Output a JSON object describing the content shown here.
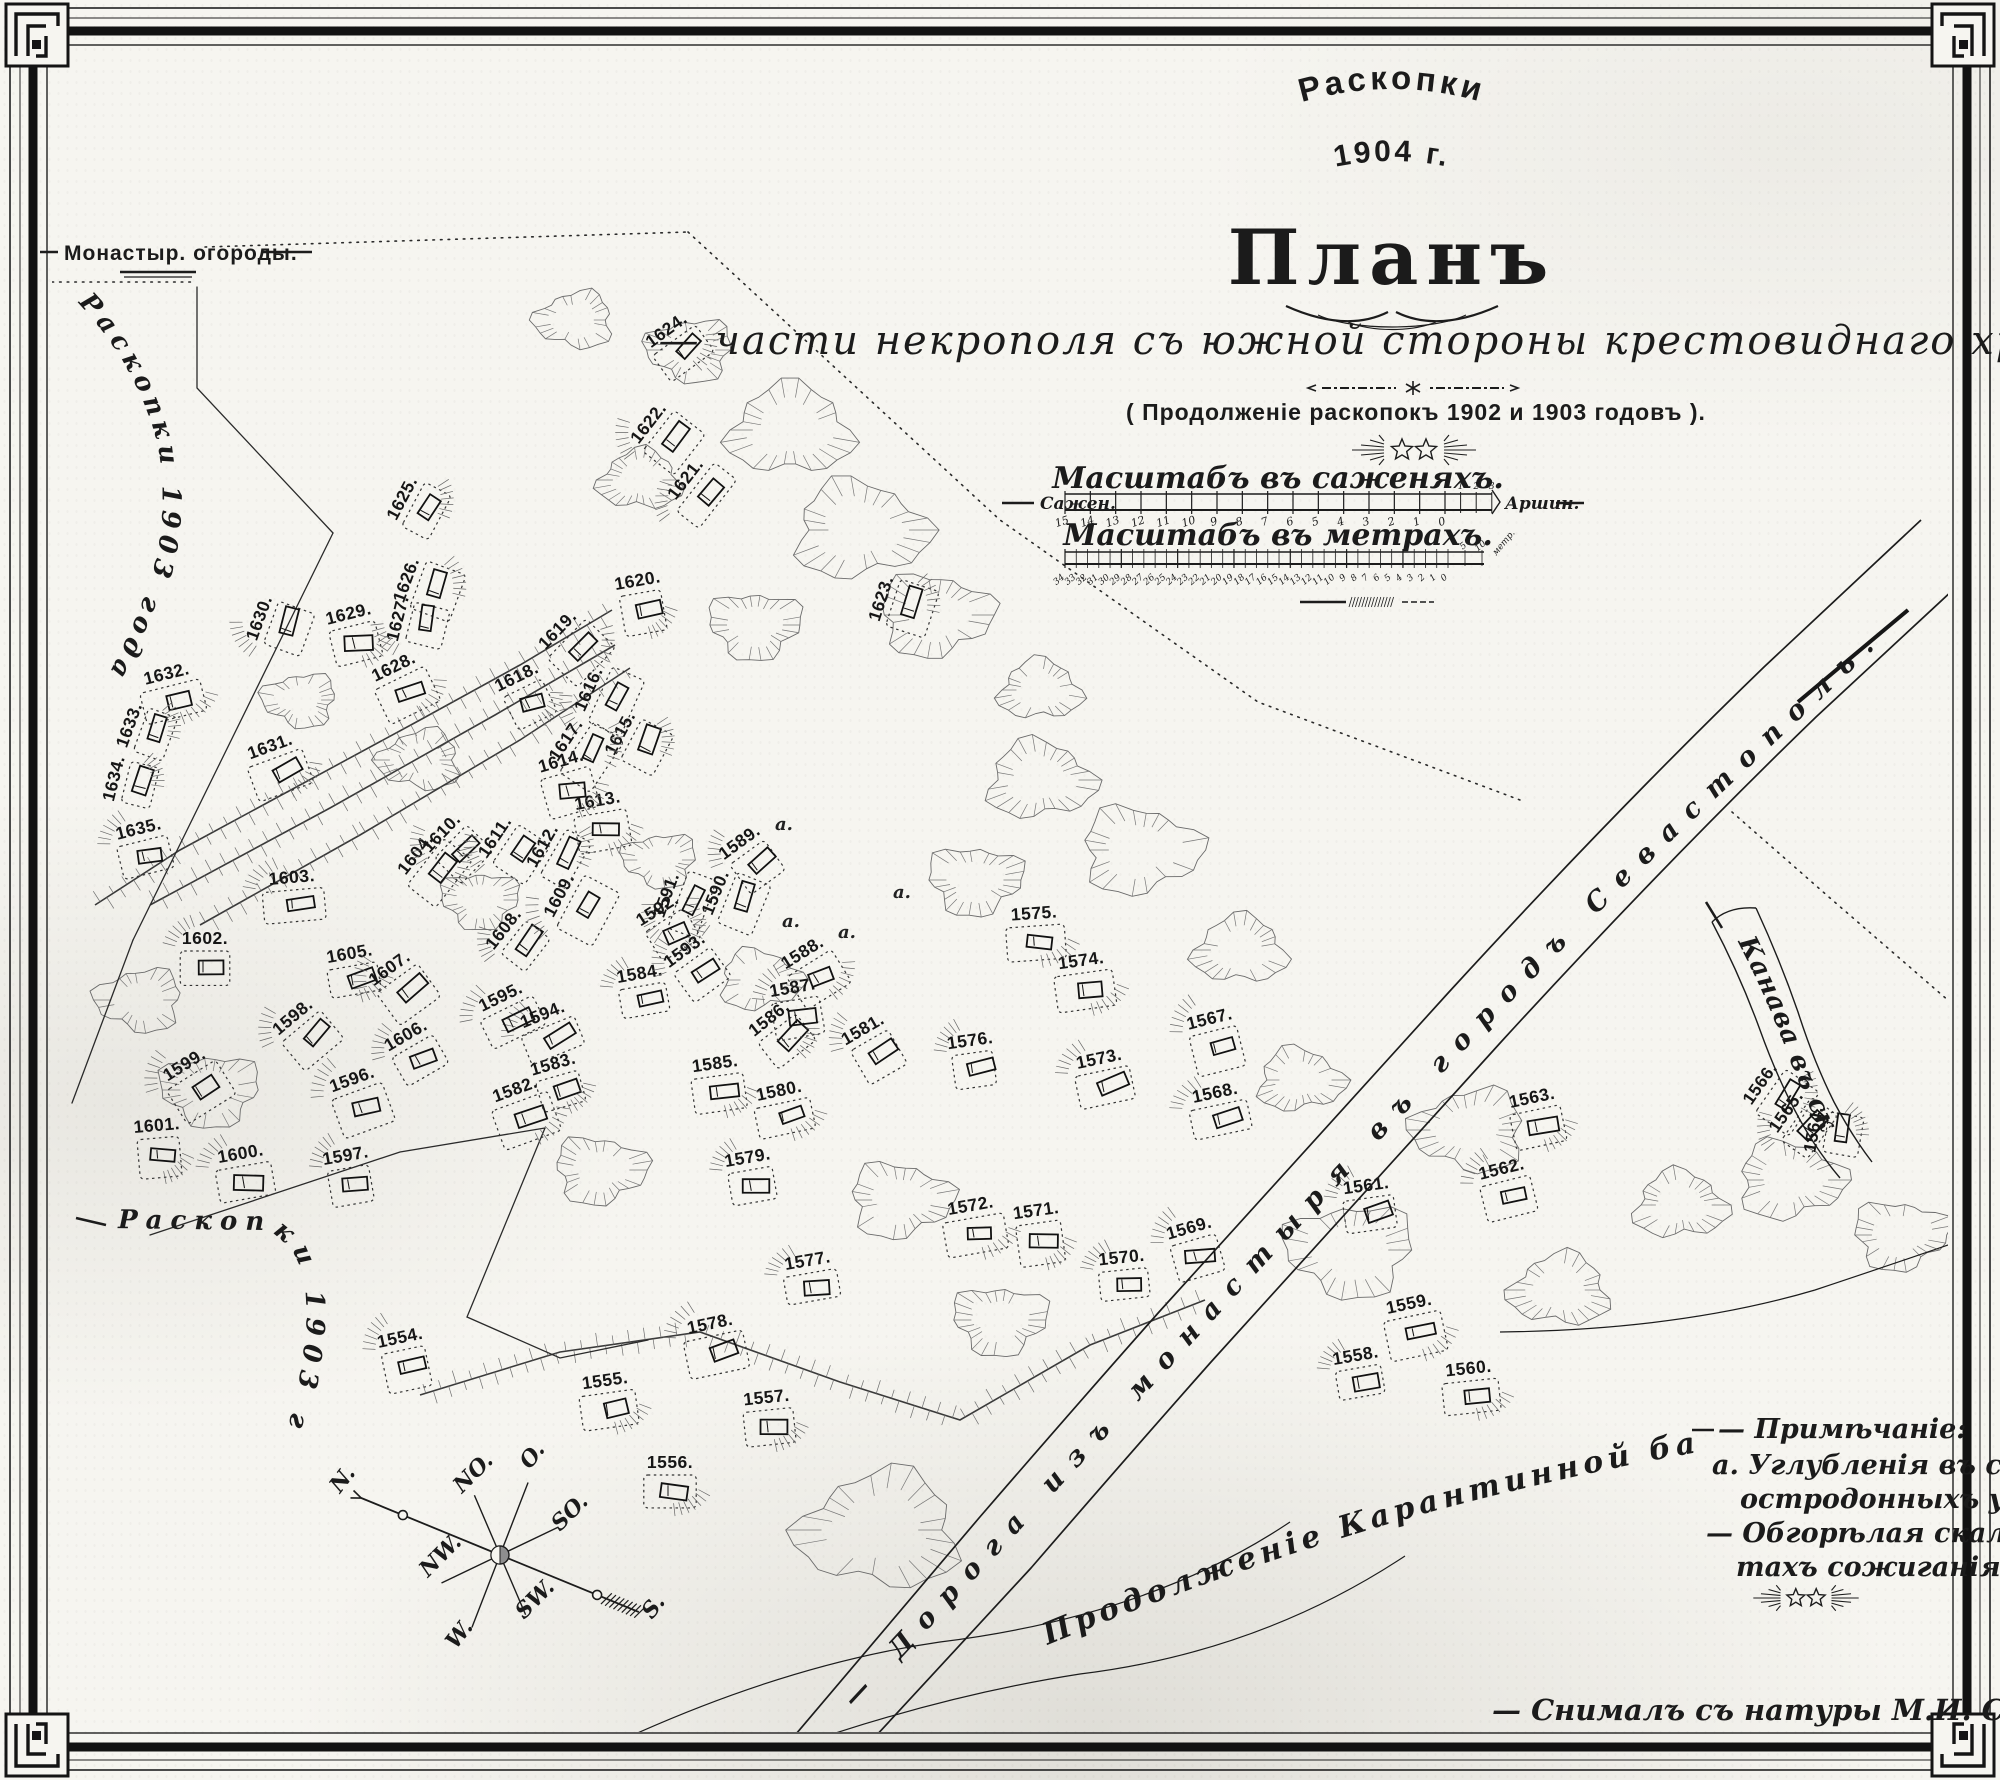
{
  "title": {
    "heading": "Раскопки",
    "year": "1904 г.",
    "plan": "Планъ",
    "subtitle": "— части некрополя съ южной стороны крестовиднаго храма. —",
    "continuation": "( Продолженіе раскопокъ 1902 и 1903 годовъ )."
  },
  "scales": {
    "sazhen_title": "Масштабъ въ саженяхъ.",
    "meter_title": "Масштабъ въ метрахъ.",
    "left_label": "Сажен.",
    "right_label": "Аршин.",
    "meter_right_label": "метр.",
    "sazhen_ticks": [
      "15",
      "14",
      "13",
      "12",
      "11",
      "10",
      "9",
      "8",
      "7",
      "6",
      "5",
      "4",
      "3",
      "2",
      "1",
      "0"
    ],
    "arshin_ticks": [
      "1",
      "2",
      "3"
    ],
    "meter_ticks": [
      "34",
      "33",
      "32",
      "31",
      "30",
      "29",
      "28",
      "27",
      "26",
      "25",
      "24",
      "23",
      "22",
      "21",
      "20",
      "19",
      "18",
      "17",
      "16",
      "15",
      "14",
      "13",
      "12",
      "11",
      "10",
      "9",
      "8",
      "7",
      "6",
      "5",
      "4",
      "3",
      "2",
      "1",
      "0"
    ],
    "meter_sub_ticks": [
      "5",
      "10"
    ]
  },
  "map_labels": {
    "monastery": "Монастыр. огороды.",
    "excavations_1903_upper": "Раскопки 1903 года.",
    "excavations_1903_lower": "Раскопки 1903 года.",
    "road_main": "— Дорога изъ монастыря въ городъ Севастополь. —",
    "road_karantin": "Продолженіе Карантинной балки.",
    "trench": "Канава въ скалѣ."
  },
  "compass": {
    "n": "N.",
    "no": "NO.",
    "o": "O.",
    "so": "SO.",
    "s": "S.",
    "sw": "SW.",
    "w": "W.",
    "nw": "NW."
  },
  "note": {
    "title": "— Примѣчаніе:",
    "line_a": "а. Углубленія въ скалѣ для",
    "line_a2": "остродонныхъ урнъ.",
    "line_b": "— Обгорѣлая скала въ мѣс=",
    "line_b2": "тахъ сожиганія труповъ."
  },
  "signature": "— Снималъ съ натуры М.И. Скубетовъ. 1904 г.,",
  "graves": {
    "format": [
      "number",
      "x",
      "y",
      "rotation"
    ],
    "items": [
      [
        "1554.",
        403,
        1352,
        -12
      ],
      [
        "1555.",
        607,
        1395,
        -8
      ],
      [
        "1556.",
        670,
        1477,
        0
      ],
      [
        "1557.",
        768,
        1412,
        -6
      ],
      [
        "1558.",
        1358,
        1370,
        -10
      ],
      [
        "1559.",
        1412,
        1318,
        -12
      ],
      [
        "1560.",
        1470,
        1383,
        -6
      ],
      [
        "1561.",
        1368,
        1200,
        -8
      ],
      [
        "1562.",
        1505,
        1183,
        -14
      ],
      [
        "1563.",
        1535,
        1112,
        -12
      ],
      [
        "1564.",
        1828,
        1132,
        -80
      ],
      [
        "1565.",
        1798,
        1120,
        -55
      ],
      [
        "1566.",
        1772,
        1092,
        -55
      ],
      [
        "1567.",
        1213,
        1033,
        -14
      ],
      [
        "1568.",
        1218,
        1107,
        -12
      ],
      [
        "1569.",
        1193,
        1242,
        -16
      ],
      [
        "1570.",
        1123,
        1272,
        -6
      ],
      [
        "1571.",
        1038,
        1225,
        -8
      ],
      [
        "1572.",
        973,
        1220,
        -10
      ],
      [
        "1573.",
        1102,
        1073,
        -12
      ],
      [
        "1574.",
        1083,
        975,
        -8
      ],
      [
        "1575.",
        1035,
        928,
        -4
      ],
      [
        "1576.",
        972,
        1055,
        -8
      ],
      [
        "1577.",
        810,
        1275,
        -10
      ],
      [
        "1578.",
        713,
        1338,
        -12
      ],
      [
        "1579.",
        750,
        1172,
        -10
      ],
      [
        "1580.",
        782,
        1105,
        -12
      ],
      [
        "1581.",
        870,
        1042,
        -30
      ],
      [
        "1582.",
        520,
        1103,
        -20
      ],
      [
        "1583.",
        557,
        1078,
        -16
      ],
      [
        "1584.",
        642,
        988,
        -10
      ],
      [
        "1585.",
        717,
        1078,
        -8
      ],
      [
        "1586.",
        778,
        1030,
        -38
      ],
      [
        "1587.",
        795,
        1002,
        -10
      ],
      [
        "1588.",
        810,
        965,
        -32
      ],
      [
        "1589.",
        748,
        854,
        -36
      ],
      [
        "1590.",
        729,
        898,
        -68
      ],
      [
        "1591.",
        680,
        900,
        -70
      ],
      [
        "1592.",
        665,
        922,
        -32
      ],
      [
        "1593.",
        693,
        962,
        -36
      ],
      [
        "1594.",
        548,
        1028,
        -22
      ],
      [
        "1595.",
        507,
        1010,
        -26
      ],
      [
        "1596.",
        357,
        1093,
        -20
      ],
      [
        "1597.",
        348,
        1170,
        -10
      ],
      [
        "1598.",
        302,
        1028,
        -40
      ],
      [
        "1599.",
        192,
        1077,
        -32
      ],
      [
        "1600.",
        243,
        1168,
        -10
      ],
      [
        "1601.",
        158,
        1140,
        -5
      ],
      [
        "1602.",
        205,
        953,
        0
      ],
      [
        "1603.",
        293,
        892,
        -5
      ],
      [
        "1604.",
        427,
        863,
        -52
      ],
      [
        "1605.",
        352,
        968,
        -10
      ],
      [
        "1606.",
        413,
        1048,
        -30
      ],
      [
        "1607.",
        398,
        980,
        -36
      ],
      [
        "1608.",
        515,
        938,
        -52
      ],
      [
        "1609.",
        572,
        902,
        -62
      ],
      [
        "1610.",
        452,
        843,
        -46
      ],
      [
        "1611.",
        507,
        845,
        -56
      ],
      [
        "1612.",
        555,
        853,
        -60
      ],
      [
        "1613.",
        600,
        815,
        -10
      ],
      [
        "1614.",
        565,
        775,
        -16
      ],
      [
        "1615.",
        633,
        740,
        -62
      ],
      [
        "1616.",
        602,
        695,
        -66
      ],
      [
        "1617.",
        578,
        748,
        -56
      ],
      [
        "1618.",
        523,
        690,
        -26
      ],
      [
        "1619.",
        568,
        640,
        -46
      ],
      [
        "1620.",
        640,
        595,
        -10
      ],
      [
        "1621.",
        697,
        488,
        -52
      ],
      [
        "1622.",
        660,
        432,
        -52
      ],
      [
        "1623.",
        895,
        603,
        -72
      ],
      [
        "1624.",
        675,
        342,
        -36
      ],
      [
        "1625.",
        415,
        505,
        -62
      ],
      [
        "1626.",
        420,
        585,
        -70
      ],
      [
        "1627.",
        412,
        622,
        -76
      ],
      [
        "1628.",
        400,
        680,
        -26
      ],
      [
        "1629.",
        352,
        628,
        -14
      ],
      [
        "1630.",
        273,
        623,
        -70
      ],
      [
        "1631.",
        275,
        760,
        -20
      ],
      [
        "1632.",
        170,
        688,
        -14
      ],
      [
        "1633.",
        143,
        730,
        -70
      ],
      [
        "1634.",
        128,
        782,
        -76
      ],
      [
        "1635.",
        142,
        843,
        -14
      ]
    ]
  },
  "annotations": [
    {
      "t": "а.",
      "x": 838,
      "y": 938
    },
    {
      "t": "а.",
      "x": 893,
      "y": 898
    },
    {
      "t": "а.",
      "x": 775,
      "y": 830
    },
    {
      "t": "а.",
      "x": 782,
      "y": 927
    }
  ]
}
